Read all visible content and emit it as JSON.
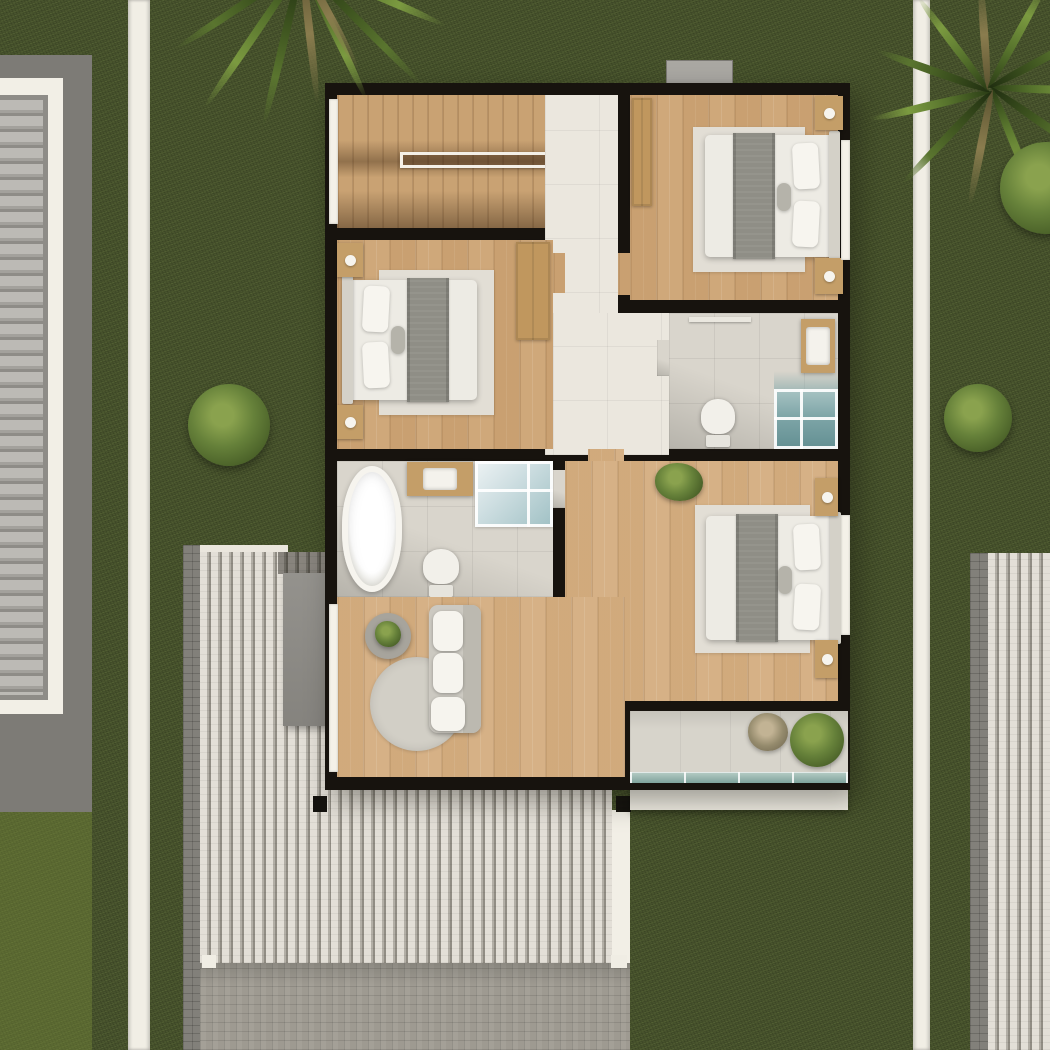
{
  "scene": {
    "description": "Top-down 3D architectural render of an upper floor plan set in a garden lot with side walkways, a block-paved driveway, a striped porch roof and neighbouring rooftops",
    "view": "plan view (bird's-eye)",
    "visible_text": "none"
  },
  "palette": {
    "grass": "#49552e",
    "grass_light": "#5c6b36",
    "path": "#f1eee5",
    "wall": "#17130e",
    "wood": "#cfa87a",
    "wood_light": "#d6b186",
    "tile": "#ebe7de",
    "bath_tile": "#d9d5cc",
    "shower_teal": "#7fa6a8",
    "roof_stripe_light": "#e3dfd7",
    "roof_stripe_dark": "#918d84",
    "paver": "#9e9a91",
    "apron": "#7d7b76",
    "white_trim": "#f2efe6",
    "bed_white": "#edebe4",
    "blanket": "#8f8e86",
    "wood_furn": "#c49e68"
  },
  "plan": {
    "counts": {
      "bedrooms": 3,
      "bathrooms": 2,
      "balconies": 1,
      "staircases": 1
    },
    "rooms": [
      {
        "id": "stair-hall",
        "label": "Staircase hall",
        "floor": "wood",
        "furniture": [
          "staircase",
          "white handrail"
        ]
      },
      {
        "id": "bedroom-top-right",
        "label": "Bedroom 1",
        "floor": "wood",
        "furniture": [
          "double bed with grey runner",
          "two nightstands with lamps",
          "closet",
          "area rug"
        ]
      },
      {
        "id": "bedroom-mid-left",
        "label": "Bedroom 2",
        "floor": "wood",
        "furniture": [
          "double bed with grey runner",
          "two nightstands",
          "wardrobe",
          "area rug"
        ]
      },
      {
        "id": "bathroom-right",
        "label": "Bathroom 1",
        "floor": "stone tile",
        "furniture": [
          "toilet",
          "wood vanity with sink",
          "teal walk-in shower with glass screen",
          "towel rail"
        ]
      },
      {
        "id": "bathroom-left",
        "label": "Bathroom 2",
        "floor": "stone tile",
        "furniture": [
          "freestanding oval bathtub",
          "wood vanity with sink",
          "glass shower enclosure",
          "toilet"
        ]
      },
      {
        "id": "hallway",
        "label": "Hallway",
        "floor": "cream tile",
        "furniture": []
      },
      {
        "id": "family-suite",
        "label": "Lounge / Bedroom 3",
        "floor": "wood",
        "furniture": [
          "double bed with grey runner",
          "two nightstands",
          "sofa with white cushions",
          "round rug",
          "round coffee table with plant",
          "floor plant"
        ]
      },
      {
        "id": "balcony",
        "label": "Balcony",
        "floor": "light tile",
        "furniture": [
          "glass railing",
          "green shrub",
          "dried shrub"
        ]
      }
    ]
  },
  "environment": {
    "left_building": "neighbouring house: corrugated metal roof with white fascia and grey apron",
    "right_building": "neighbouring striped roof with dark paver edge strip",
    "walkways": [
      "white sidewalk along left side",
      "white sidewalk along right side"
    ],
    "driveway": "grey block-paved driveway at bottom under a white-striped porch roof",
    "roof_details": [
      "grey chimney box on north wall",
      "grey flat canopy on west porch roof",
      "two black support posts",
      "white parapet below balcony"
    ],
    "vegetation": [
      "palm tree top-left",
      "palm tree top-right",
      "round shrub on left lawn",
      "round shrub on right lawn",
      "round shrub top-right corner",
      "lawn grass"
    ]
  }
}
